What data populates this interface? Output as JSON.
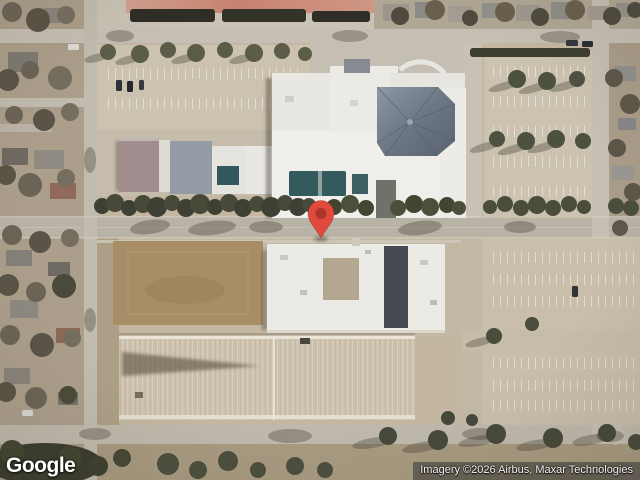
{
  "map": {
    "view_type": "satellite",
    "marker": {
      "color": "#E1493D",
      "dot_color": "#AC352B"
    }
  },
  "branding": {
    "logo_text": "Google"
  },
  "attribution": {
    "text": "Imagery ©2026 Airbus, Maxar Technologies"
  }
}
